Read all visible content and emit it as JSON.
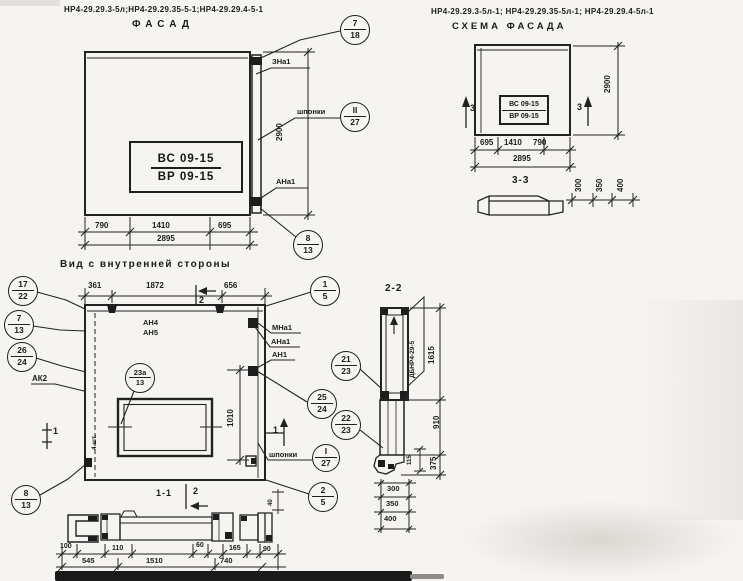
{
  "facade": {
    "codes": "НР4-29.29.3-5л;НР4-29.29.35-5-1;НР4-29.29.4-5-1",
    "title": "ФАСАД",
    "stamp": {
      "line1": "ВС 09-15",
      "line2": "ВР 09-15"
    },
    "labels": {
      "zna1": "ЗНа1",
      "shponki": "шпонки",
      "ana1": "АНа1"
    },
    "callouts": {
      "top": {
        "num": "7",
        "den": "18"
      },
      "shponki": {
        "num": "II",
        "den": "27"
      },
      "bottom": {
        "num": "8",
        "den": "13"
      }
    },
    "dims": {
      "w1": "790",
      "w2": "1410",
      "w3": "695",
      "total": "2895",
      "height": "2900"
    }
  },
  "scheme": {
    "codes": "НР4-29.29.3-5л-1; НР4-29.29.35-5л-1; НР4-29.29.4-5л-1",
    "title": "СХЕМА ФАСАДА",
    "stamp": {
      "line1": "ВС 09-15",
      "line2": "ВР 09-15"
    },
    "section_marker": "3",
    "dims": {
      "w1": "695",
      "w2": "1410",
      "w3": "790",
      "total": "2895",
      "height": "2900"
    },
    "section33": {
      "title": "3-3",
      "d1": "300",
      "d2": "350",
      "d3": "400"
    }
  },
  "inner_view": {
    "title": "Вид с внутренней стороны",
    "dims": {
      "t1": "361",
      "t2": "1872",
      "t3": "656",
      "window_h": "1010"
    },
    "section2_marker": "2",
    "section1_marker": "1",
    "labels": {
      "an4": "АН4",
      "an5": "АН5",
      "mna1": "МНа1",
      "ana1": "АНа1",
      "an1": "АН1",
      "ak2": "АК2",
      "shponki": "шпонки",
      "note": "4 шт."
    },
    "callouts": {
      "c17_22": {
        "num": "17",
        "den": "22"
      },
      "c7_13": {
        "num": "7",
        "den": "13"
      },
      "c26_24": {
        "num": "26",
        "den": "24"
      },
      "c23a_13": {
        "num": "23а",
        "den": "13"
      },
      "c8_13": {
        "num": "8",
        "den": "13"
      },
      "c1_5": {
        "num": "1",
        "den": "5"
      },
      "c21_23": {
        "num": "21",
        "den": "23"
      },
      "c25_24": {
        "num": "25",
        "den": "24"
      },
      "c22_23": {
        "num": "22",
        "den": "23"
      },
      "cI_27": {
        "num": "I",
        "den": "27"
      },
      "c2_5": {
        "num": "2",
        "den": "5"
      }
    }
  },
  "section22": {
    "title": "2-2",
    "panel_label": "ДБНР4-29-5",
    "dims": {
      "h1": "1615",
      "h2": "910",
      "h3": "375",
      "small": "115",
      "b1": "300",
      "b2": "350",
      "b3": "400"
    }
  },
  "section11": {
    "title": "1-1",
    "marker": "2",
    "dims": {
      "s1": "100",
      "s2": "110",
      "s3": "60",
      "s4": "165",
      "s5": "90",
      "b1": "545",
      "b2": "1510",
      "b3": "740",
      "small": "40"
    }
  }
}
